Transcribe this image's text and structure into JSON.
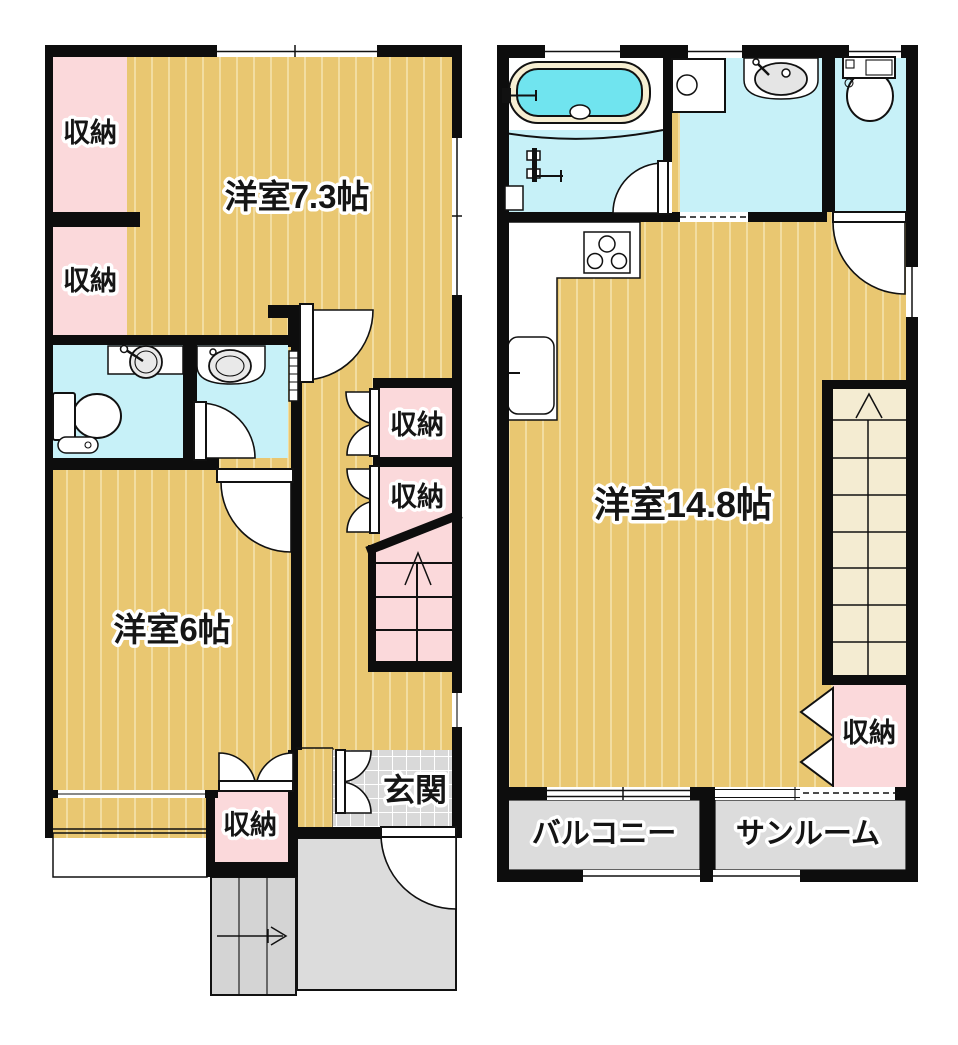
{
  "rooms": {
    "f1_closet_a": "収納",
    "f1_closet_b": "収納",
    "f1_room73": "洋室7.3帖",
    "f1_closet_r1": "収納",
    "f1_closet_r2": "収納",
    "f1_room6": "洋室6帖",
    "f1_closet_bottom": "収納",
    "f1_entrance": "玄関",
    "f2_room148": "洋室14.8帖",
    "f2_closet": "収納",
    "f2_balcony": "バルコニー",
    "f2_sunroom": "サンルーム"
  },
  "colors": {
    "floor_wood": "#E9C771",
    "floor_stripe": "#F2DDA1",
    "closet_pink": "#FBD9DB",
    "wet_cyan": "#C7F1F8",
    "tub_water": "#70E4EF",
    "tub_rim": "#F6EED2",
    "tile_gray": "#D9D9D9",
    "stair_cream": "#F4ECD2",
    "outdoor_gray": "#DCDCDC",
    "outside_stair_gray": "#D4D4D4",
    "wall": "#0D0D0D"
  }
}
